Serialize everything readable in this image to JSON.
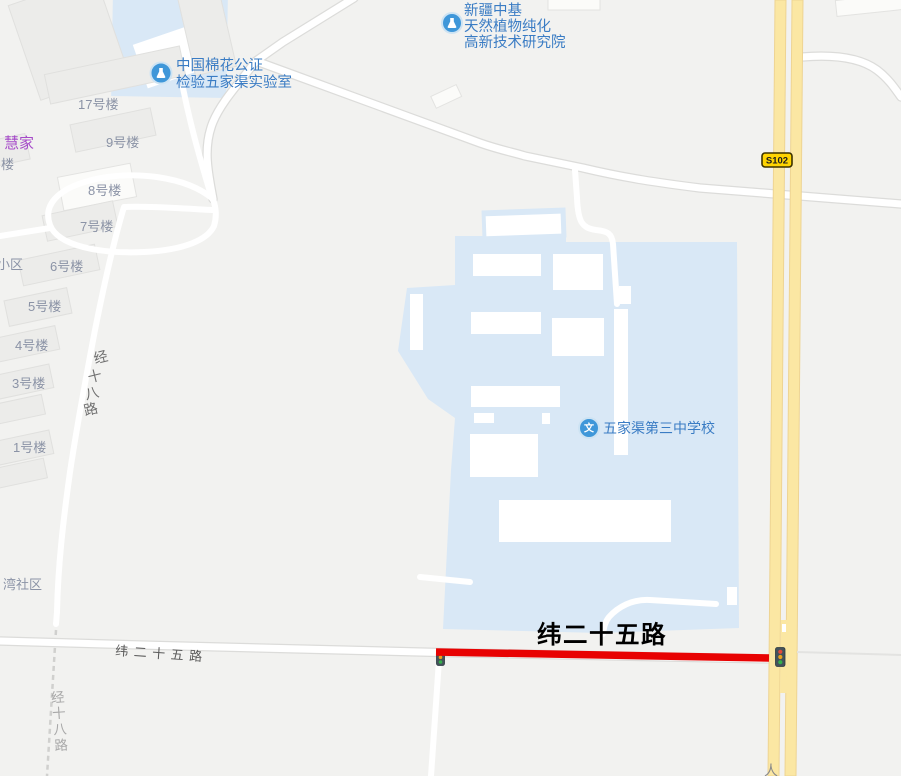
{
  "pois": {
    "research_institute": {
      "line1": "新疆中基",
      "line2": "天然植物纯化",
      "line3": "高新技术研究院"
    },
    "cotton_lab": {
      "line1": "中国棉花公证",
      "line2": "检验五家渠实验室"
    },
    "school": {
      "name": "五家渠第三中学校",
      "icon_glyph": "文"
    }
  },
  "road_labels": {
    "highlighted_road_big": "纬二十五路",
    "weier25_on_road": "纬二十五路",
    "s102_badge": "S102",
    "jing18_chars": [
      "经",
      "十",
      "八",
      "路"
    ],
    "renmin_partial": "人"
  },
  "building_labels": {
    "b17": "17号楼",
    "b9": "9号楼",
    "b8": "8号楼",
    "b7": "7号楼",
    "b6": "6号楼",
    "b5": "5号楼",
    "b4": "4号楼",
    "b3": "3号楼",
    "b1": "1号楼",
    "partial_lou": "楼",
    "partial_xiaoqu": "小区",
    "huijia": "慧家",
    "wan_shequ": "湾社区"
  },
  "colors": {
    "campus_blue": "#d9e8f6",
    "highway_yellow": "#fbe7a3",
    "route_highlight_red": "#e80202",
    "poi_icon_blue": "#3f97d9",
    "poi_label_blue": "#3a7cc4",
    "brand_label_purple": "#a64ac9",
    "badge_yellow": "#ffd402",
    "big_road_label_black": "#000000"
  }
}
